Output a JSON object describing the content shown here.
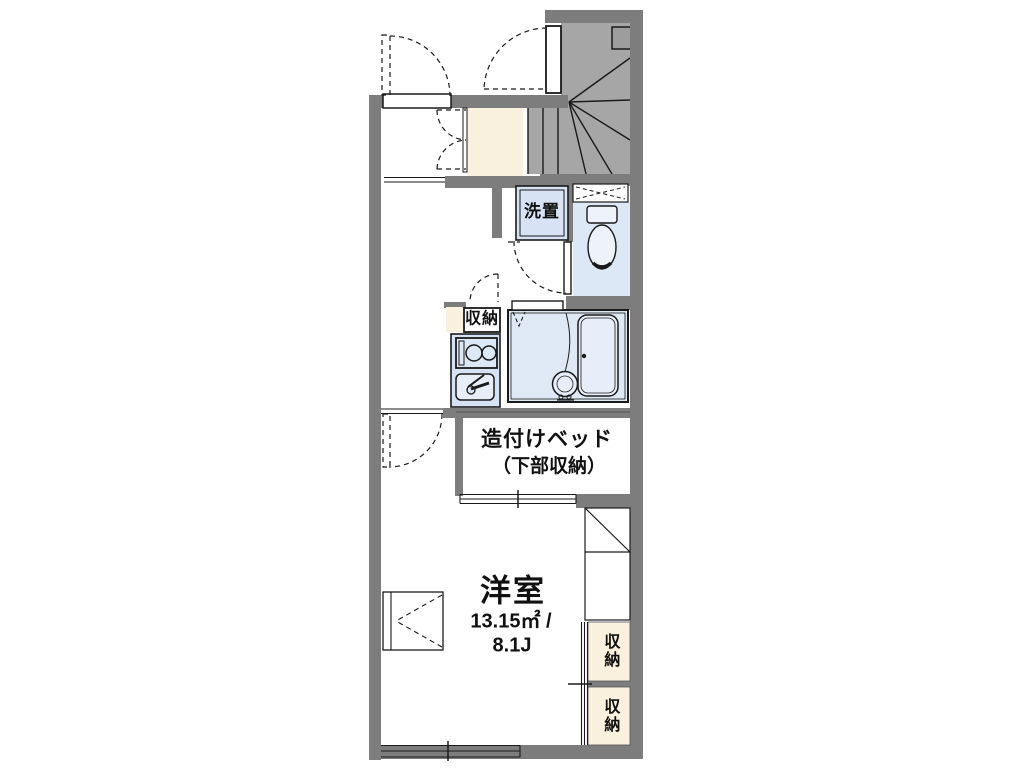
{
  "floor_plan": {
    "washer_label": "洗置",
    "kitchen_closet_label": "収納",
    "bed_label_line1": "造付けベッド",
    "bed_label_line2": "（下部収納）",
    "room": {
      "name": "洋室",
      "area_sqm": "13.15㎡ /",
      "area_tatami": "8.1J"
    },
    "closet_top_label": "収納",
    "closet_bottom_label": "収納",
    "colors": {
      "wall": "#7d7d7d",
      "stairs": "#a6a6a6",
      "entry_cream": "#faf0de",
      "water_blue": "#dde8f6",
      "background": "#ffffff"
    }
  }
}
